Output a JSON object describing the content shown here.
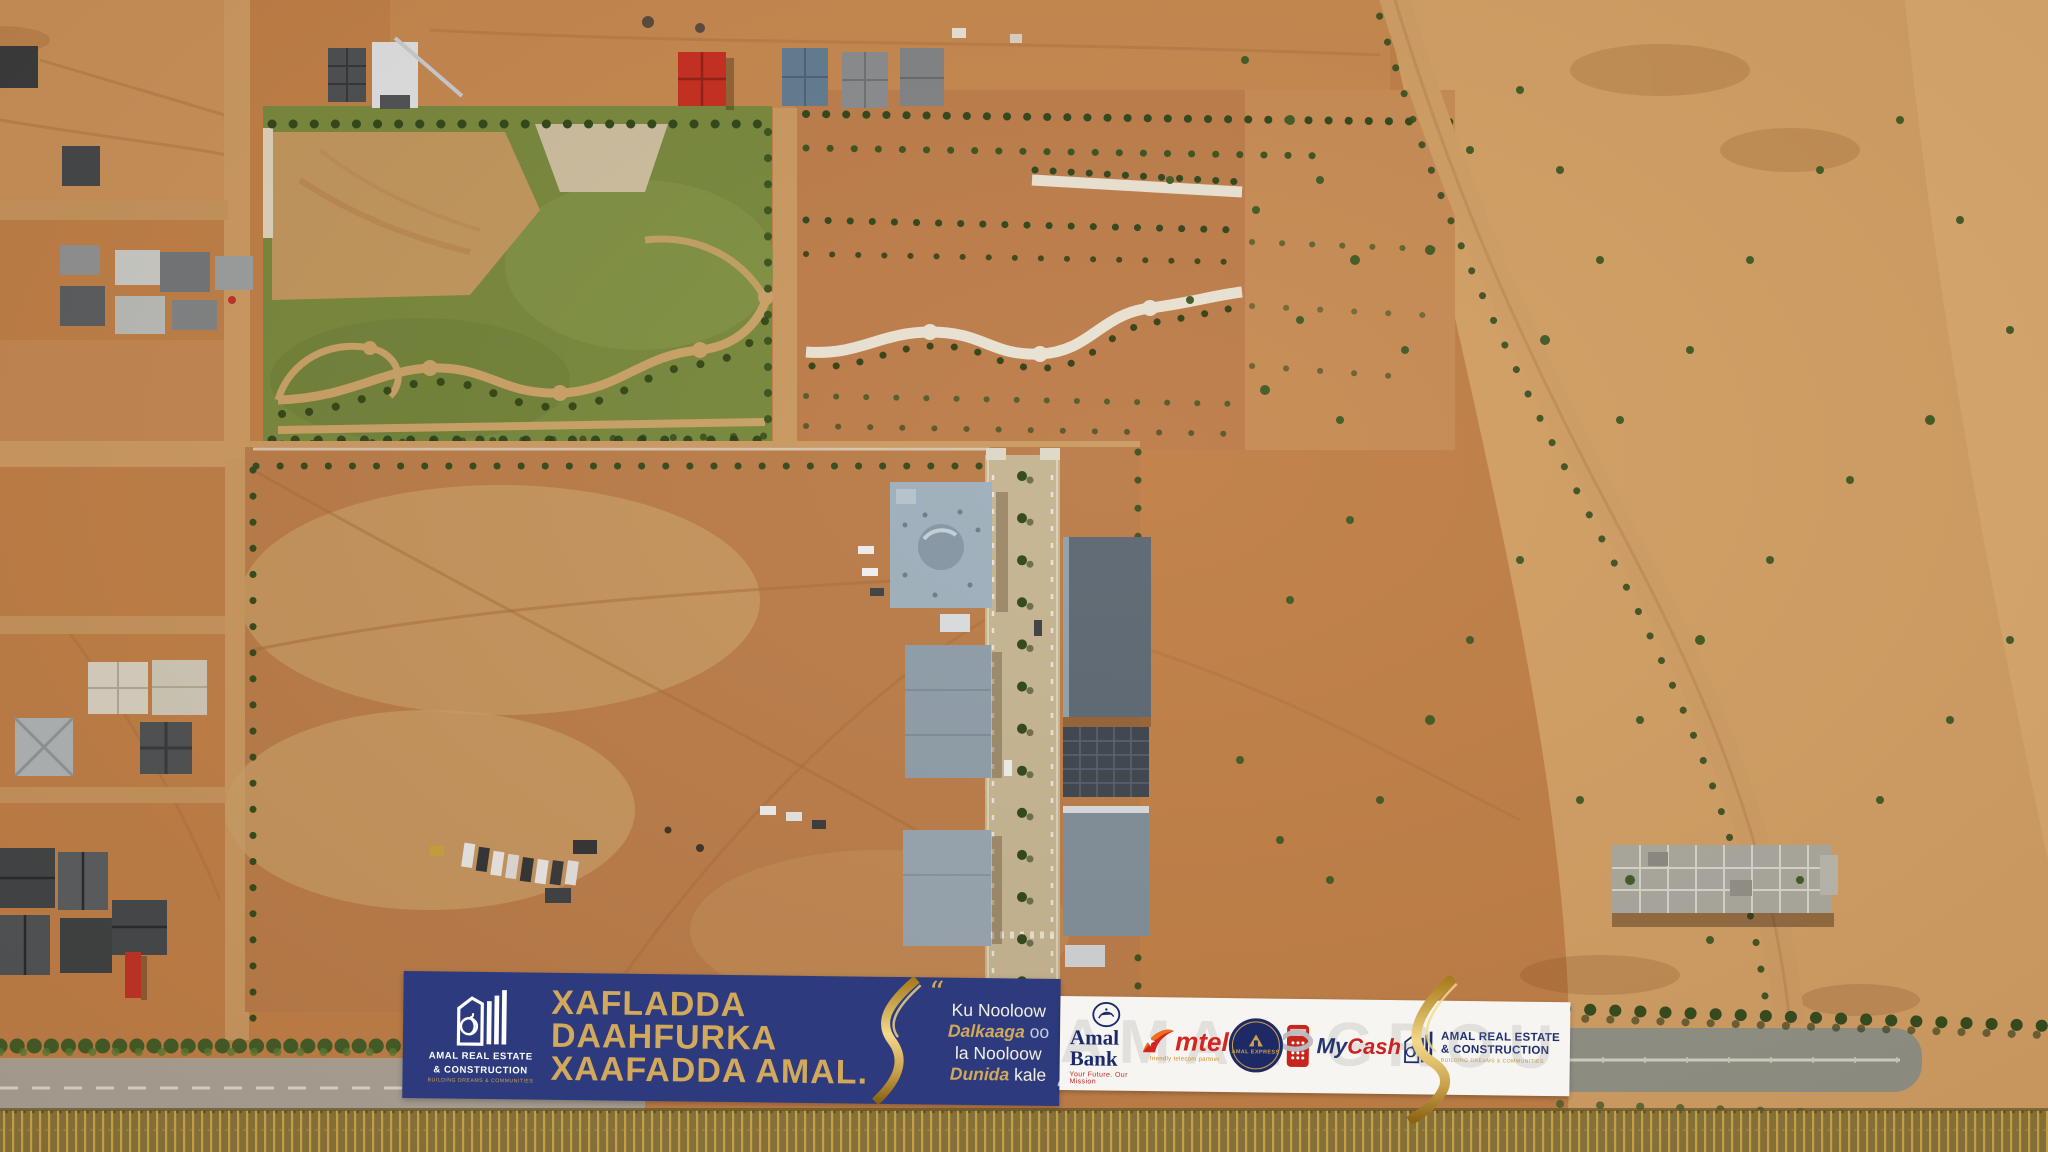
{
  "banner": {
    "logo": {
      "line1": "AMAL REAL ESTATE",
      "line2": "& CONSTRUCTION",
      "tagline": "BUILDING DREAMS & COMMUNITIES"
    },
    "headline": {
      "line1": "XAFLADDA",
      "line2": "DAAHFURKA",
      "line3": "XAAFADDA AMAL."
    },
    "quote": {
      "open": "“",
      "line1": "Ku Nooloow",
      "line2_gold": "Dalkaaga",
      "line2_rest": "oo",
      "line3": "la Nooloow",
      "line4_gold": "Dunida",
      "line4_rest": "kale",
      "close": "“"
    },
    "sponsors": {
      "watermark": "AMAL GROUP",
      "amal_bank": {
        "name": "Amal Bank",
        "tagline": "Your Future. Our Mission"
      },
      "amtel": {
        "name": "Amtel",
        "name_display": "mtel",
        "tagline": "friendly telecom partner"
      },
      "amal_express": {
        "name": "AMAL EXPRESS"
      },
      "mycash": {
        "my": "My",
        "cash": "Cash"
      },
      "amal_rec": {
        "line1": "AMAL REAL ESTATE",
        "line2": "& CONSTRUCTION",
        "tagline": "BUILDING DREAMS & COMMUNITIES"
      }
    }
  },
  "colors": {
    "banner_navy": "#2d3b7e",
    "gold": "#d2a85a",
    "white_strip": "#f6f5f1",
    "terrain_base": "#bf7f47",
    "park_green": "#75883d"
  }
}
